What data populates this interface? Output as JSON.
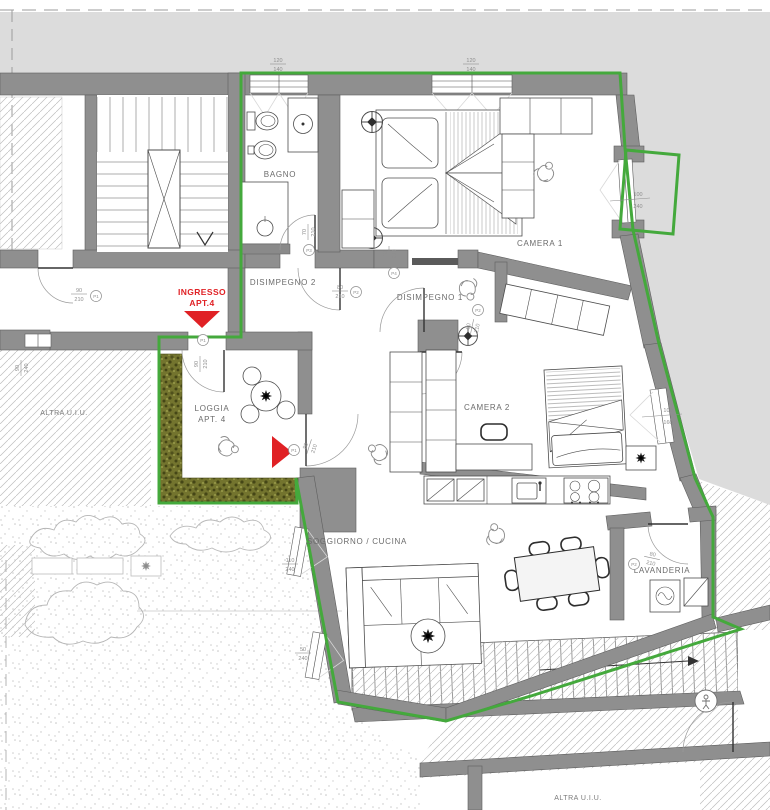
{
  "title": "Floor plan apartment 4",
  "colors": {
    "boundary_green": "#44a93c",
    "red": "#e02125",
    "wall_gray": "#8f8f8f",
    "outside_gray": "#dcdcdc"
  },
  "rooms": {
    "bagno": "BAGNO",
    "camera1": "CAMERA 1",
    "disimpegno2": "DISIMPEGNO 2",
    "disimpegno1": "DISIMPEGNO 1",
    "camera2": "CAMERA 2",
    "soggiorno": "SOGGIORNO / CUCINA",
    "lavanderia": "LAVANDERIA",
    "loggia_line1": "LOGGIA",
    "loggia_line2": "APT. 4",
    "altra_left": "ALTRA U.I.U.",
    "altra_bottom": "ALTRA U.I.U."
  },
  "entrance": {
    "line1": "INGRESSO",
    "line2": "APT.4"
  },
  "dims": {
    "p1": {
      "w": "90",
      "h": "210",
      "tag": "P1"
    },
    "p2": {
      "w": "80",
      "h": "210",
      "tag": "P2"
    },
    "p3": {
      "w": "70",
      "h": "210",
      "tag": "P3"
    },
    "p4": {
      "w": "40",
      "h": "210",
      "tag": "P4"
    },
    "f_balcony": {
      "w": "100",
      "h": "240"
    },
    "f_camera2": {
      "w": "100",
      "h": "160"
    },
    "f_sog_large": {
      "w": "110",
      "h": "240"
    },
    "f_sog_small": {
      "w": "50",
      "h": "240"
    },
    "f_altra": {
      "w": "90",
      "h": "240"
    },
    "f_top": {
      "w": "120",
      "h": "140"
    }
  }
}
